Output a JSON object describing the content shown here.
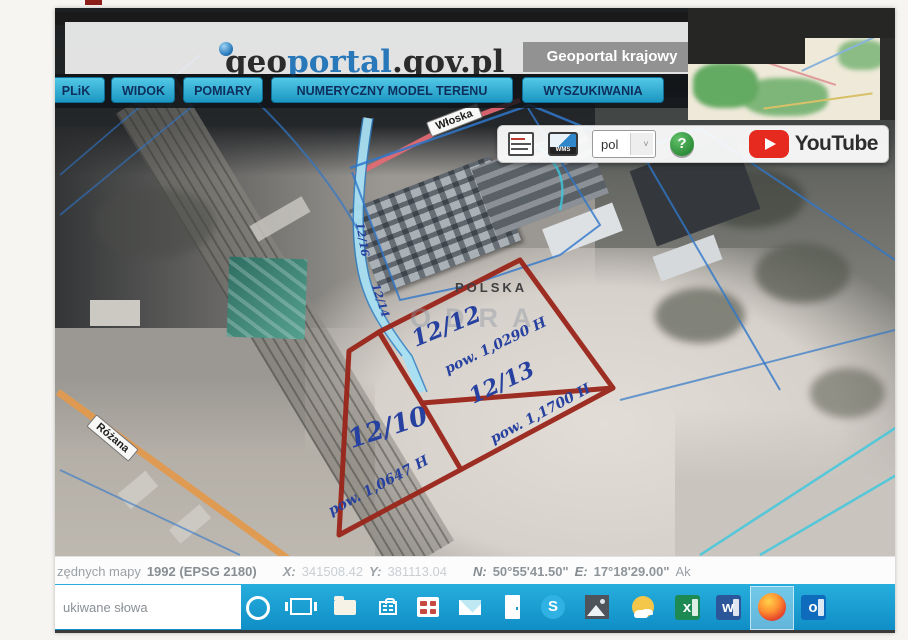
{
  "header": {
    "logo": {
      "pre": "geo",
      "highlight": "portal",
      "suffix": ".gov.pl"
    },
    "badge": "Geoportal krajowy"
  },
  "menu": {
    "items": [
      {
        "label": "PLiK"
      },
      {
        "label": "WIDOK"
      },
      {
        "label": "POMIARY"
      },
      {
        "label": "NUMERYCZNY MODEL TERENU"
      },
      {
        "label": "WYSZUKIWANIA"
      }
    ]
  },
  "toolbar": {
    "wms_icon_label": "WMS",
    "language_select": {
      "value": "pol"
    },
    "help_label": "?",
    "youtube_label": "YouTube"
  },
  "map": {
    "streets": {
      "wloska": "Włoska",
      "rozana": "Różana"
    },
    "watermark_country": "POLSKA",
    "watermark_odra": "ODRA",
    "parcels": [
      {
        "id": "12/12",
        "area": "pow. 1,0290 H"
      },
      {
        "id": "12/13",
        "area": "pow. 1,1700 H"
      },
      {
        "id": "12/10",
        "area": "pow. 1,0647 H"
      }
    ],
    "edge_notes": [
      "12/16",
      "12/14"
    ]
  },
  "statusbar": {
    "label_prefix": "zędnych mapy",
    "crs": "1992 (EPSG 2180)",
    "x_label": "X:",
    "x_value": "341508.42",
    "y_label": "Y:",
    "y_value": "381113.04",
    "n_label": "N:",
    "n_value": "50°55'41.50\"",
    "e_label": "E:",
    "e_value": "17°18'29.00\"",
    "suffix": "Ak"
  },
  "taskbar": {
    "search_placeholder": "ukiwane słowa",
    "glyphs": {
      "skype": "S",
      "excel": "x",
      "word": "w",
      "outlook": "o"
    }
  },
  "colors": {
    "taskbar_blue": "#17a0d8",
    "menu_cyan": "#2fb4da",
    "parcel_red": "#9a251a",
    "annotation_blue": "#26419f",
    "logo_blue": "#2878ba"
  }
}
